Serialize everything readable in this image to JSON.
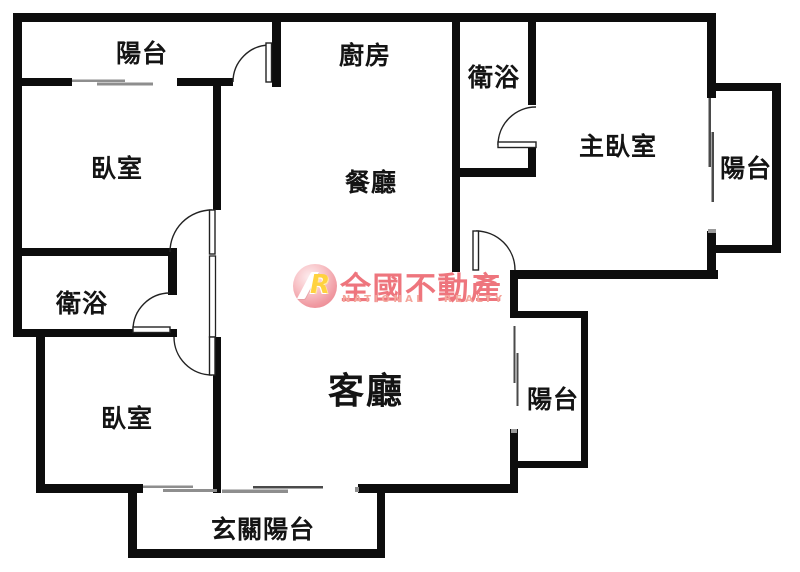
{
  "document": {
    "title": "apartment floor plan"
  },
  "rooms": {
    "balcony_top": "陽台",
    "kitchen": "廚房",
    "bathroom_top": "衛浴",
    "master_bedroom": "主臥室",
    "balcony_right": "陽台",
    "bedroom_top_left": "臥室",
    "dining": "餐廳",
    "bathroom_left": "衛浴",
    "bedroom_bottom_left": "臥室",
    "living": "客廳",
    "balcony_bottom_right": "陽台",
    "entry_balcony": "玄關陽台"
  },
  "watermark": {
    "logo_monogram": "R",
    "brand_name": "全國不動產",
    "brand_name_en": "NATIONAL REALTY",
    "brand_color": "#ee757d",
    "brand_color_light": "#f4a69c",
    "logo_yellow": "#ffd23f"
  },
  "colors": {
    "wall": "#0d0d0d",
    "background": "#ffffff",
    "label": "#141414",
    "window_gray": "#8e8e8e",
    "window_dark": "#4a4a4a"
  }
}
